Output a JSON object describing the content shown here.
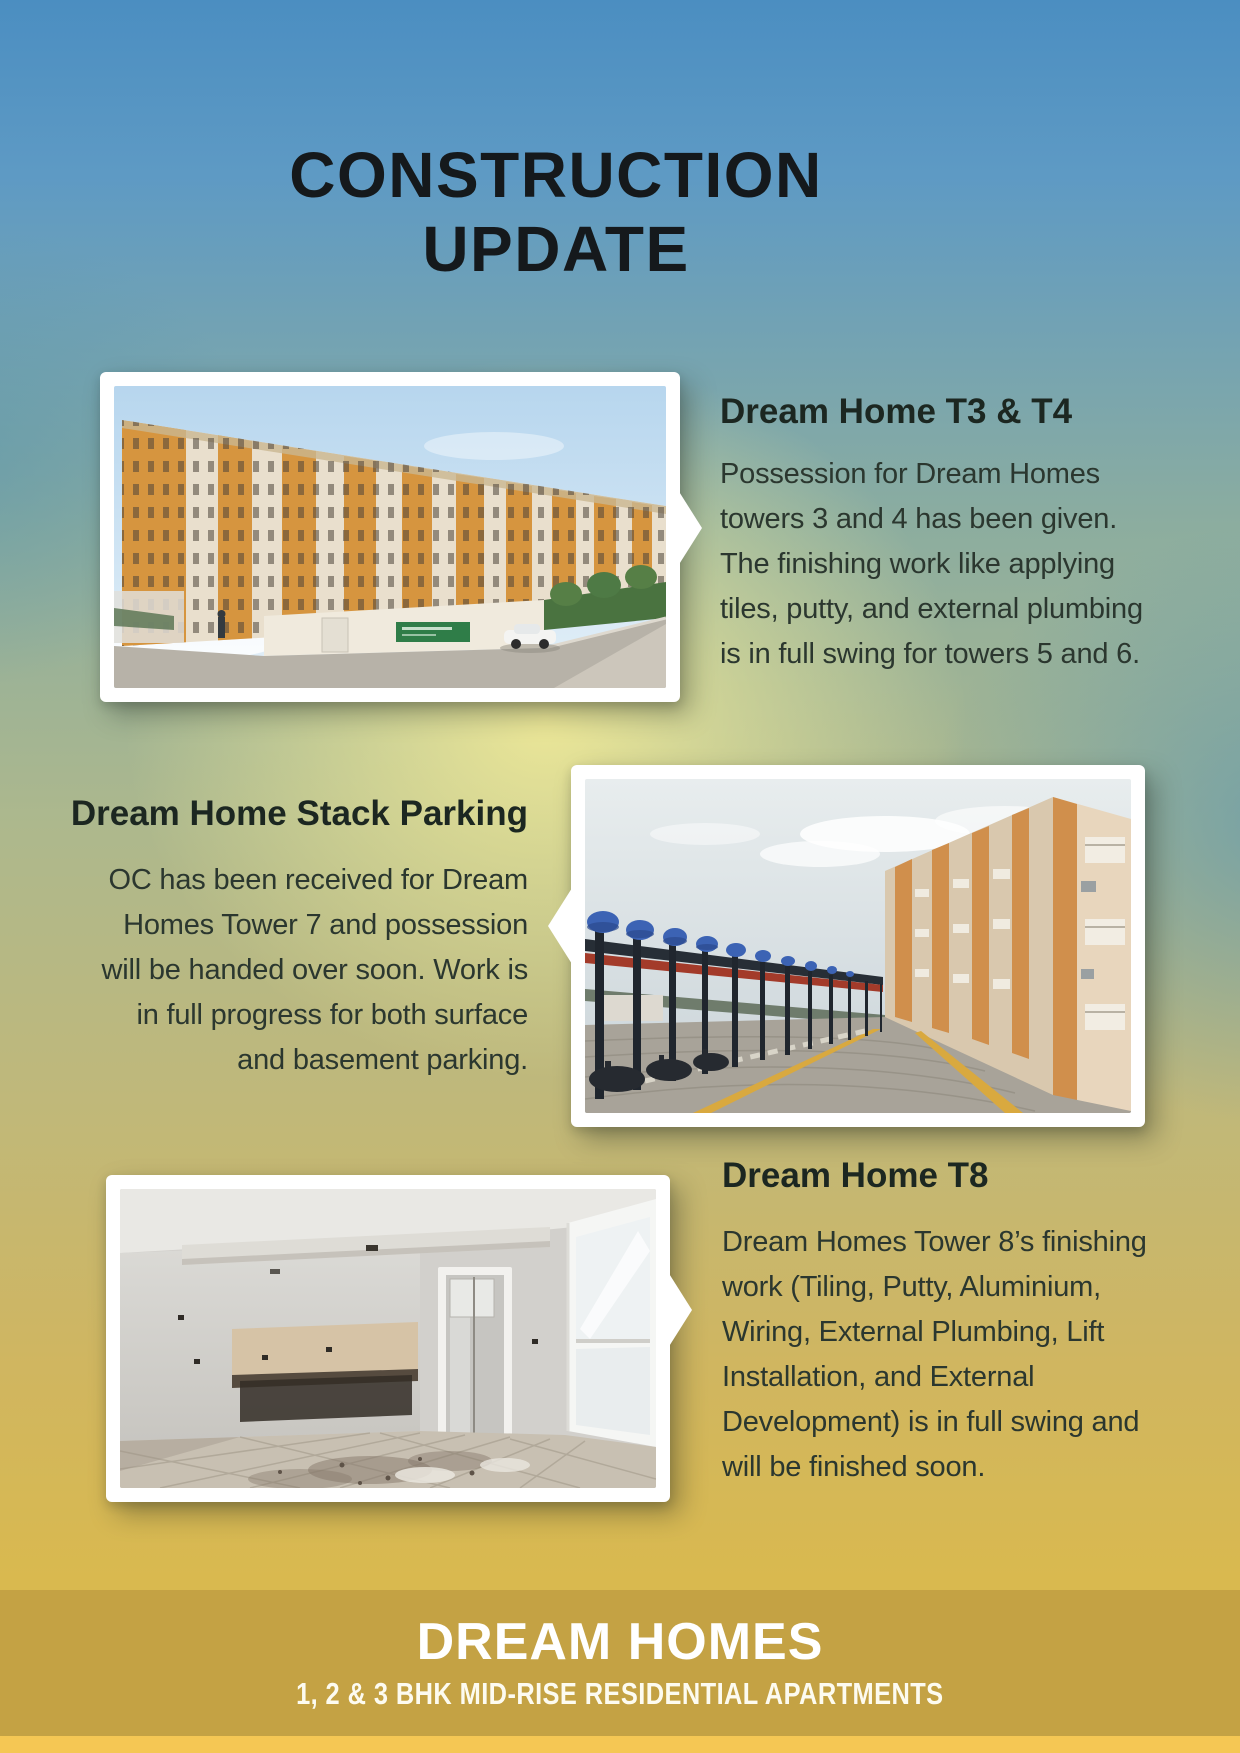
{
  "poster": {
    "title": {
      "line1": "CONSTRUCTION",
      "line2": "UPDATE"
    }
  },
  "sections": [
    {
      "id": "t3-t4",
      "heading": "Dream Home T3 & T4",
      "photo_alt": "Exterior photo of completed orange and cream apartment towers receding under a blue sky, with boundary wall, green project sign, hedge and a white car",
      "body_lines": [
        "Possession for Dream Homes",
        "towers 3 and 4 has been given.",
        "The finishing work like applying",
        "tiles, putty, and external plumbing",
        "is in full swing for towers 5 and 6."
      ]
    },
    {
      "id": "stack-parking",
      "heading": "Dream Home Stack Parking",
      "photo_alt": "Photo of a long row of blue stack-parking machines on steel frames beside a brick-paved drive with yellow lines and an apartment tower facade on the right",
      "body_lines": [
        "OC has been received for Dream",
        "Homes Tower 7 and possession",
        "will be handed over soon. Work is",
        "in full progress for both surface",
        "and basement parking."
      ]
    },
    {
      "id": "t8",
      "heading": "Dream Home T8",
      "photo_alt": "Photo of an unfinished apartment interior with bare plastered walls, kitchen counter slab, door frame and a bright window over a stained tiled floor",
      "body_lines": [
        "Dream Homes Tower 8’s finishing",
        "work (Tiling, Putty, Aluminium,",
        "Wiring, External Plumbing, Lift",
        "Installation, and External",
        "Development) is in full swing and",
        "will be finished soon."
      ]
    }
  ],
  "footer": {
    "brand": "DREAM HOMES",
    "tagline": "1, 2 & 3 BHK MID-RISE RESIDENTIAL APARTMENTS"
  },
  "colors": {
    "sky_blue_top": "#4b8ec1",
    "yellow_glow": "#ece59b",
    "olive_mid": "#adb88d",
    "gold_bottom": "#dcbb4c",
    "footer_band": "#c4a244",
    "footer_strip": "#f5c754",
    "title_text": "#15191c",
    "heading_text": "#1c2721",
    "body_text": "#2b372f",
    "frame_white": "#ffffff"
  }
}
